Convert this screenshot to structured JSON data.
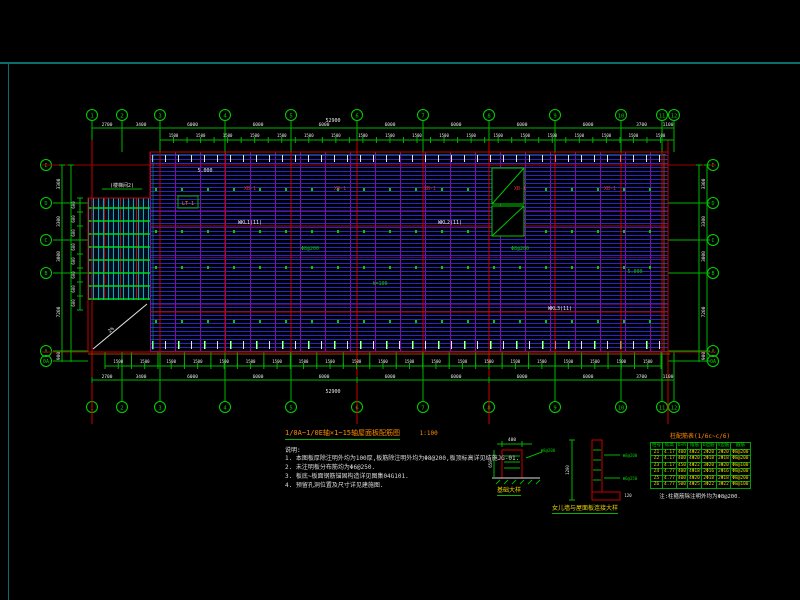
{
  "colors": {
    "grid_green": "#00b400",
    "bubble_green": "#00d400",
    "red": "#c80000",
    "dark_red": "#a00000",
    "orange_line": "#8a4500",
    "cyan": "#00a0a0",
    "white": "#e8e8e8",
    "yellow": "#e8d400",
    "title_orange": "#ff8c00"
  },
  "title_block": {
    "title": "1/0A~1/0E轴×1~15轴屋面板配筋图",
    "scale": "1:100",
    "notes_heading": "说明:",
    "notes": [
      "1. 本图板厚除注明外均为100厚,板筋除注明外均为Φ8@200,板顶标高详见结施JG-01.",
      "2. 未注明板分布筋均为Φ6@250.",
      "3. 板底~板面钢筋锚固构造详见图集04G101.",
      "4. 预留孔洞位置及尺寸详见建施图."
    ]
  },
  "grid": {
    "x_axes": [
      {
        "x": 92,
        "label": "1"
      },
      {
        "x": 122,
        "label": "2"
      },
      {
        "x": 160,
        "label": "3"
      },
      {
        "x": 225,
        "label": "4"
      },
      {
        "x": 291,
        "label": "5"
      },
      {
        "x": 357,
        "label": "6"
      },
      {
        "x": 423,
        "label": "7"
      },
      {
        "x": 489,
        "label": "8"
      },
      {
        "x": 555,
        "label": "9"
      },
      {
        "x": 621,
        "label": "10"
      },
      {
        "x": 662,
        "label": "11"
      },
      {
        "x": 674,
        "label": "12"
      }
    ],
    "y_axes": [
      {
        "y": 165,
        "label": "E"
      },
      {
        "y": 203,
        "label": "D"
      },
      {
        "y": 240,
        "label": "C"
      },
      {
        "y": 273,
        "label": "B"
      },
      {
        "y": 351,
        "label": "A"
      },
      {
        "y": 361,
        "label": "0A"
      }
    ]
  },
  "dimensions": {
    "top_bays": [
      "2700",
      "3400",
      "6000",
      "6000",
      "6000",
      "6000",
      "6000",
      "6000",
      "6000",
      "3700",
      "1100"
    ],
    "top_total": "52900",
    "top_sub": {
      "count": 38,
      "value": "1500"
    },
    "bottom_bays": [
      "2700",
      "3400",
      "6000",
      "6000",
      "6000",
      "6000",
      "6000",
      "6000",
      "6000",
      "3700",
      "1100"
    ],
    "bottom_total": "52900",
    "bottom_sub": {
      "count": 42,
      "value": "1500"
    },
    "left_rows": [
      "3300",
      "3300",
      "3000",
      "7200",
      "900"
    ],
    "right_rows": [
      "3300",
      "3300",
      "3000",
      "7200",
      "900"
    ],
    "left_sub": {
      "count": 8,
      "value": "600"
    }
  },
  "plan": {
    "annotations": [
      {
        "text": "(楼梯间2)",
        "x": 122,
        "y": 187,
        "color": "#e8e8e8",
        "size": 5,
        "ul": true
      },
      {
        "text": "LT-1",
        "x": 188,
        "y": 205,
        "color": "#ff8000",
        "size": 5,
        "box": true
      },
      {
        "text": "5.000",
        "x": 205,
        "y": 172,
        "color": "#e8e8e8",
        "size": 5
      },
      {
        "text": "XB-1",
        "x": 250,
        "y": 190,
        "color": "#cc3333",
        "size": 5
      },
      {
        "text": "XB-1",
        "x": 340,
        "y": 190,
        "color": "#cc3333",
        "size": 5
      },
      {
        "text": "XB-1",
        "x": 430,
        "y": 190,
        "color": "#cc3333",
        "size": 5
      },
      {
        "text": "XB-1",
        "x": 520,
        "y": 190,
        "color": "#cc3333",
        "size": 5
      },
      {
        "text": "XB-1",
        "x": 610,
        "y": 190,
        "color": "#cc3333",
        "size": 5
      },
      {
        "text": "WKL1(11)",
        "x": 250,
        "y": 224,
        "color": "#e8e8e8",
        "size": 5
      },
      {
        "text": "WKL2(11)",
        "x": 450,
        "y": 224,
        "color": "#e8e8e8",
        "size": 5
      },
      {
        "text": "WKL3(11)",
        "x": 560,
        "y": 310,
        "color": "#e8e8e8",
        "size": 5
      },
      {
        "text": "Φ8@200",
        "x": 310,
        "y": 250,
        "color": "#00cc00",
        "size": 5
      },
      {
        "text": "Φ8@200",
        "x": 520,
        "y": 250,
        "color": "#00cc00",
        "size": 5
      },
      {
        "text": "h=100",
        "x": 380,
        "y": 285,
        "color": "#00cc00",
        "size": 5
      },
      {
        "text": "5.000",
        "x": 635,
        "y": 273,
        "color": "#00cc00",
        "size": 5
      },
      {
        "text": "2%",
        "x": 112,
        "y": 331,
        "color": "#e8e8e8",
        "size": 5,
        "rot": -40
      }
    ]
  },
  "details": {
    "detail_left": {
      "caption": "基础大样",
      "dim_top": "400",
      "dim_side": "650",
      "note": "Φ8@200"
    },
    "detail_right": {
      "caption": "女儿墙与屋面板连接大样",
      "dim_side": "1200",
      "note1": "Φ8@200",
      "note2": "Φ6@250",
      "dim_bottom": "120"
    }
  },
  "table": {
    "title": "柱配筋表(1/6c~c/6)",
    "caption": "注:柱箍筋除注明外均为Φ8@200.",
    "columns": [
      "柱号",
      "标高",
      "b×h",
      "角筋",
      "b边筋",
      "h边筋",
      "箍筋"
    ],
    "rows": [
      [
        "Z1",
        "4.17",
        "400",
        "4Φ22",
        "2Φ20",
        "2Φ20",
        "Φ8@200"
      ],
      [
        "Z2",
        "4.17",
        "400",
        "4Φ20",
        "2Φ18",
        "2Φ18",
        "Φ8@200"
      ],
      [
        "Z3",
        "4.17",
        "450",
        "4Φ22",
        "3Φ20",
        "3Φ20",
        "Φ8@100"
      ],
      [
        "Z4",
        "4.77",
        "400",
        "4Φ18",
        "2Φ16",
        "2Φ16",
        "Φ8@200"
      ],
      [
        "Z5",
        "4.77",
        "400",
        "4Φ20",
        "2Φ18",
        "2Φ18",
        "Φ8@200"
      ],
      [
        "Z6",
        "4.77",
        "500",
        "4Φ25",
        "3Φ22",
        "3Φ22",
        "Φ8@100"
      ]
    ]
  }
}
